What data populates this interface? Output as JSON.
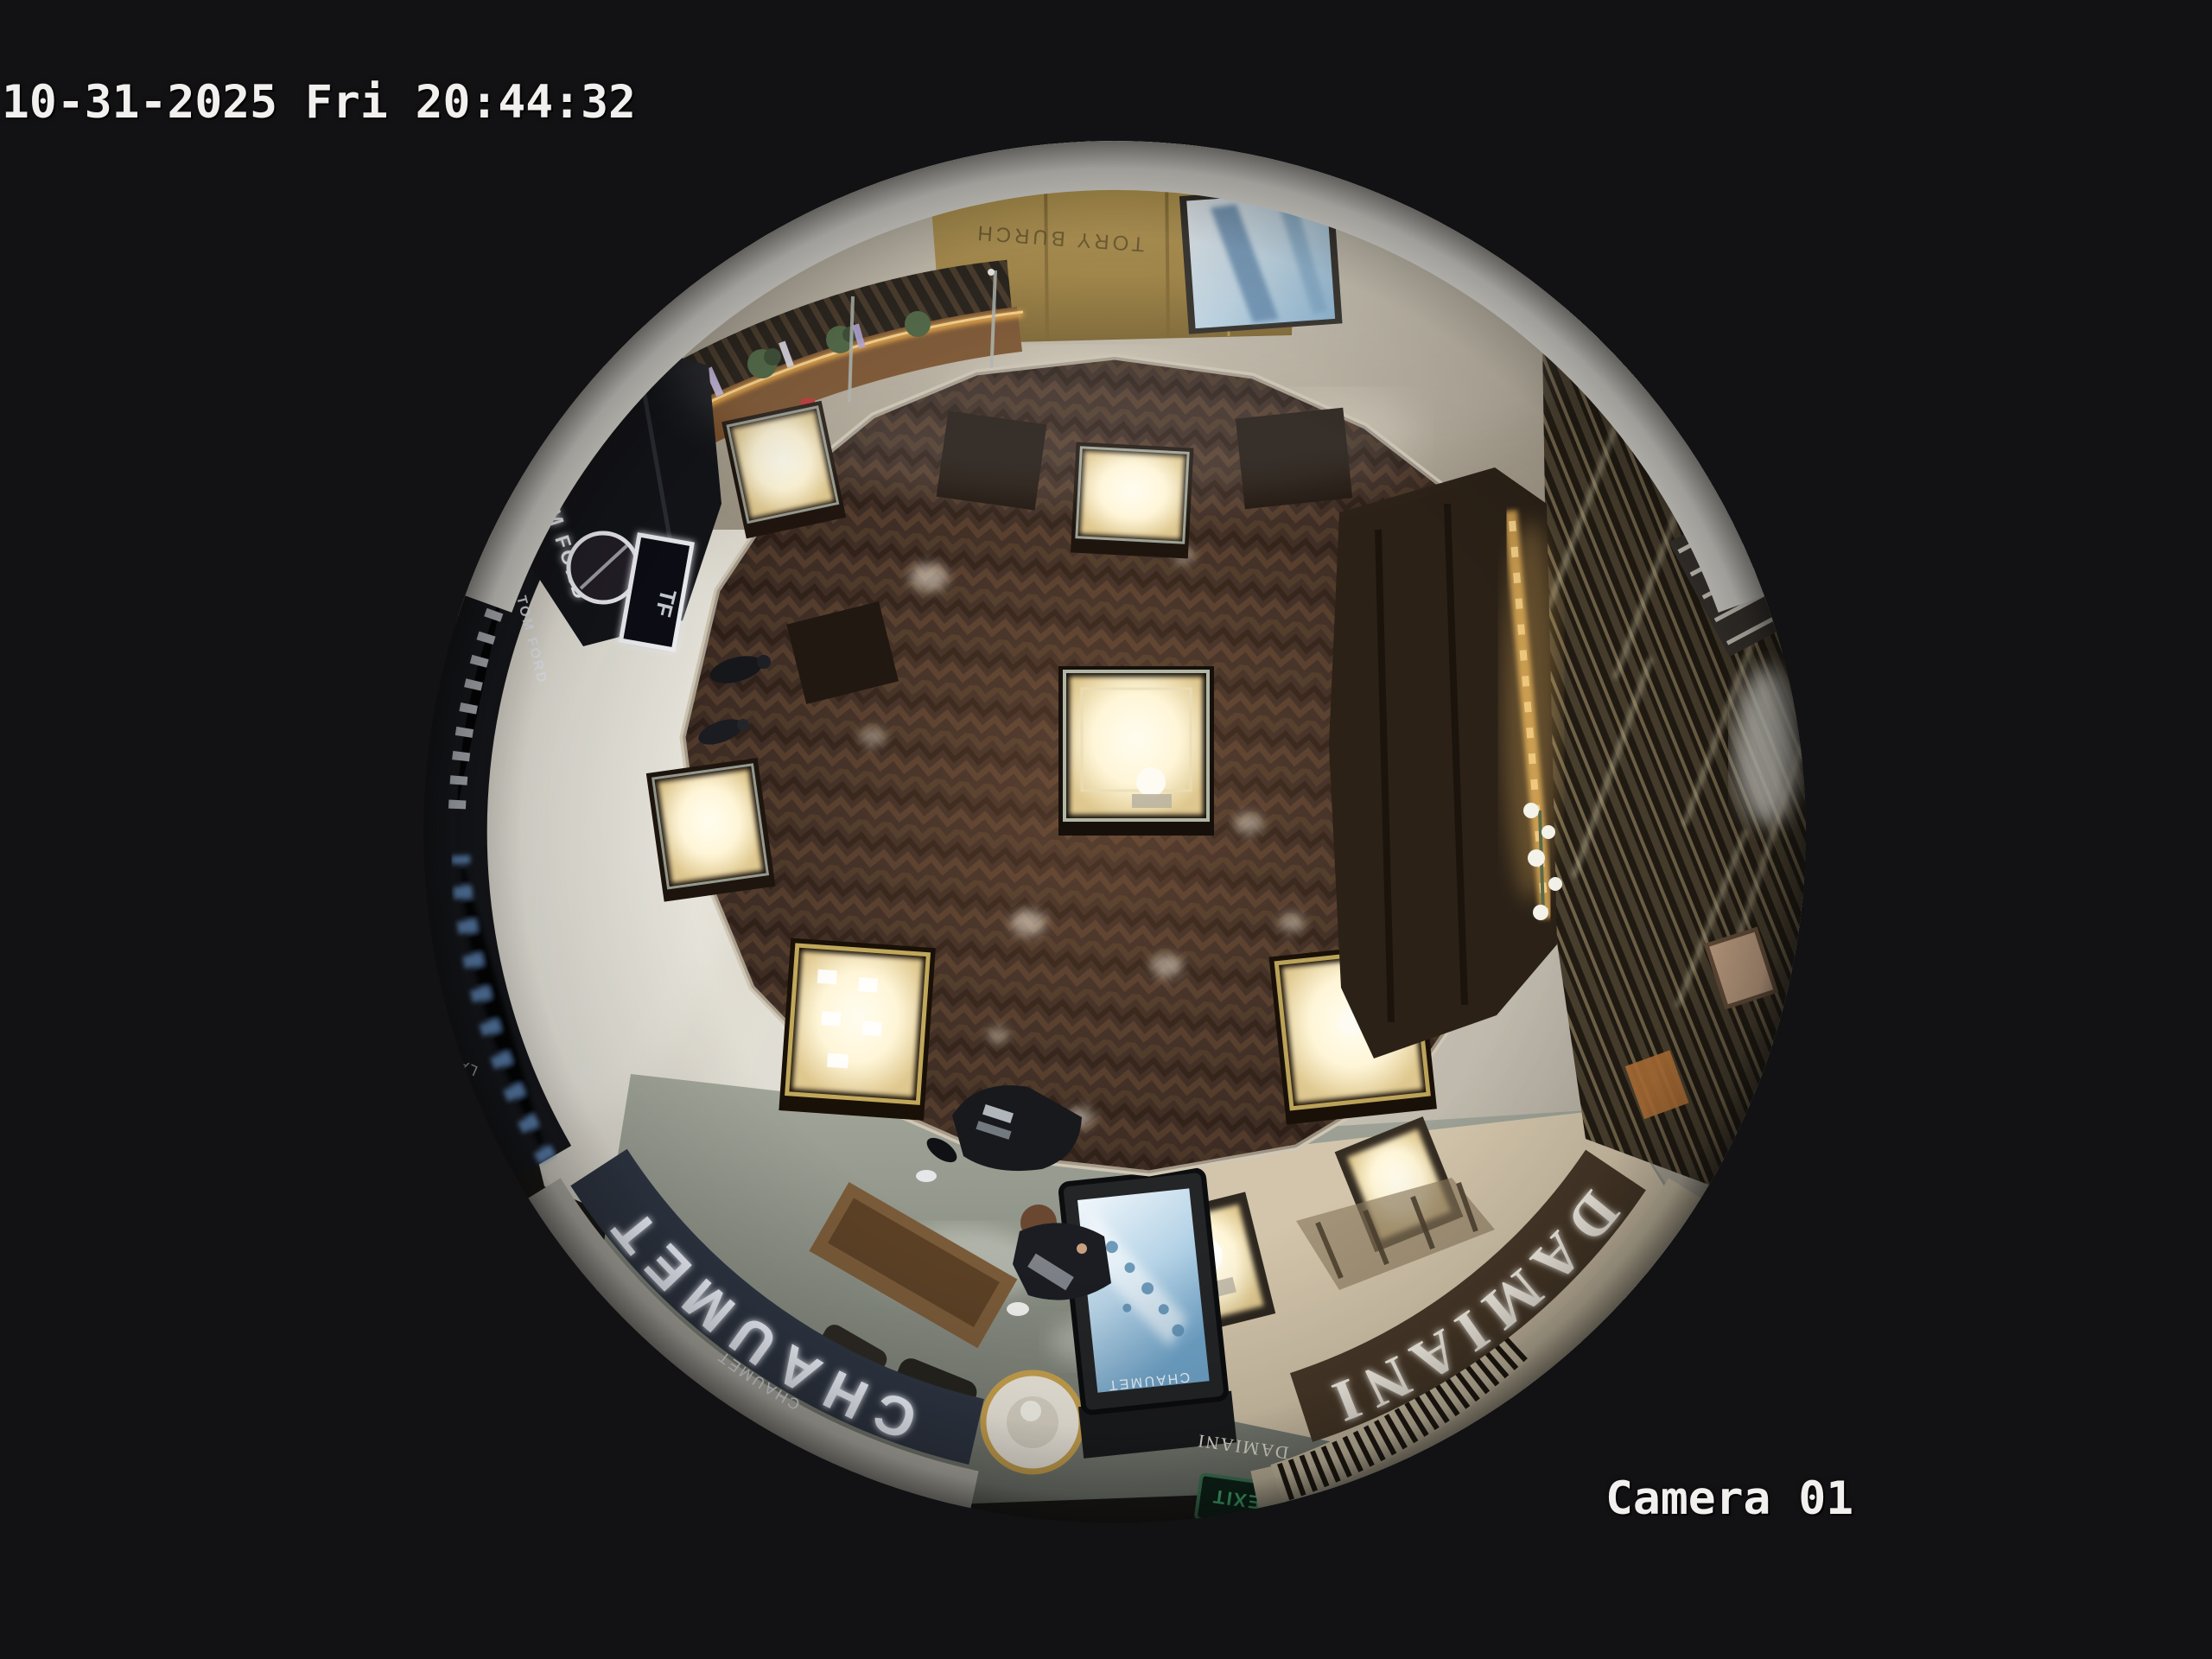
{
  "osd": {
    "timestamp": "10-31-2025 Fri 20:44:32",
    "camera_label": "Camera 01"
  },
  "scene": {
    "signs": {
      "tom_ford": "TOM FORD",
      "tom_ford_secondary": "TOM FORD",
      "tf_monogram": "TF",
      "chaumet_fascia": "CHAUMET",
      "chaumet_fascia_small": "CHAUMET",
      "chaumet_totem": "CHAUMET",
      "damiani_fascia": "DAMIANI",
      "damiani_small": "DAMIANI",
      "la_mer_counter": "LA MER",
      "corridor_store": "TORY BURCH",
      "exit_sign": "EXIT"
    }
  },
  "colors": {
    "background": "#121214",
    "osd_text": "#f2f0ee",
    "wood_floor": "#42312a",
    "marble_corridor": "#b7ae9d",
    "walkway_tile": "#d9d5cb",
    "gold_wall": "#a9883f",
    "led_strip": "#f2a83e",
    "screen_blue": "#9cc4e0",
    "vitrine_glow": "#fff6d8",
    "chaumet_band": "#2e3542",
    "damiani_band": "#473828",
    "exit_green": "#46c47e"
  }
}
